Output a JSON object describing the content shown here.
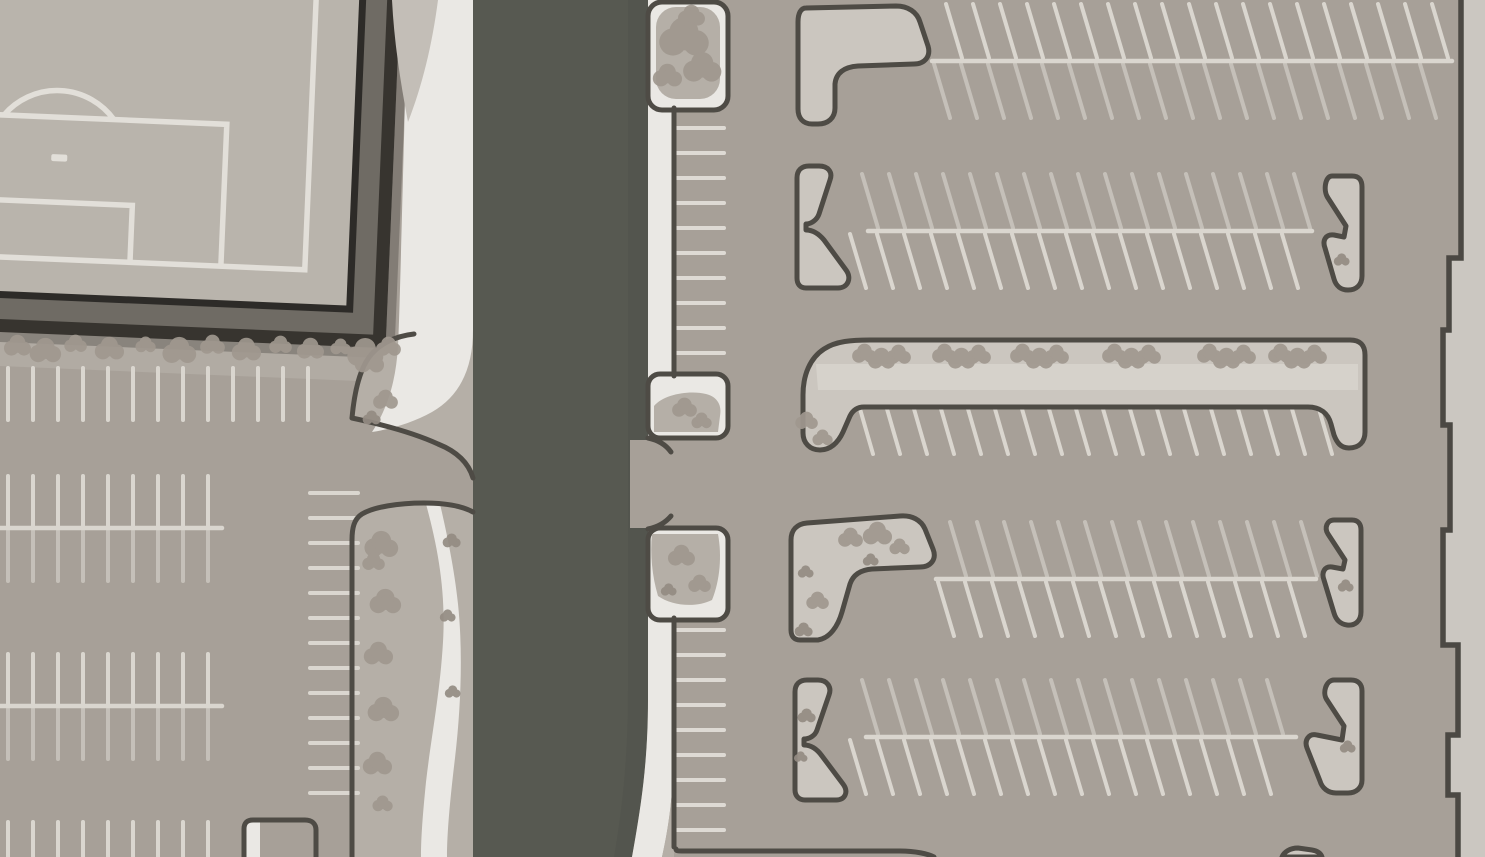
{
  "scene": {
    "type": "site-plan-map",
    "view": "top-down",
    "elements": [
      "sports-field",
      "road",
      "west-parking-lot",
      "east-parking-lot",
      "landscaped-medians",
      "parking-islands",
      "building-east-edge"
    ]
  },
  "palette": {
    "asphalt": "#a7a098",
    "road": "#575951",
    "road_shade": "#4f514b",
    "sidewalk": "#eae8e4",
    "median": "#b5afa7",
    "verge": "#c3beb7",
    "island": "#cbc6bf",
    "island_path": "#d6d2cb",
    "curb": "#4e4b45",
    "line_bright": "#dad6cf",
    "line_dim": "#c5c0b9",
    "line_white": "#dedad4",
    "tree": "#a0988f",
    "tree_small": "#948c83",
    "fence_outer": "#37342f",
    "fence_mid": "#6f6b64",
    "fence_inner": "#2d2b28",
    "field": "#b9b4ac",
    "field_line": "#e2dfd9",
    "planting": "#b1aba3",
    "building": "#cbc7c1",
    "wall": "#4b4843",
    "shadow": "rgba(35,33,30,0.28)"
  },
  "parking": {
    "stall_groups": [
      {
        "id": "left-top-row",
        "orient": "v",
        "x": 8,
        "y": 368,
        "count": 13,
        "spacing": 25,
        "length": 52,
        "tone": "bright"
      },
      {
        "id": "left-rowA-upper",
        "orient": "v",
        "x": 8,
        "y": 476,
        "count": 9,
        "spacing": 25,
        "length": 50,
        "tone": "bright"
      },
      {
        "id": "left-rowA-lower",
        "orient": "v",
        "x": 8,
        "y": 531,
        "count": 9,
        "spacing": 25,
        "length": 50,
        "tone": "dim"
      },
      {
        "id": "left-rowB-upper",
        "orient": "v",
        "x": 8,
        "y": 654,
        "count": 9,
        "spacing": 25,
        "length": 50,
        "tone": "bright"
      },
      {
        "id": "left-rowB-lower",
        "orient": "v",
        "x": 8,
        "y": 709,
        "count": 9,
        "spacing": 25,
        "length": 50,
        "tone": "dim"
      },
      {
        "id": "left-bottom-row",
        "orient": "v",
        "x": 8,
        "y": 822,
        "count": 9,
        "spacing": 25,
        "length": 35,
        "tone": "bright"
      },
      {
        "id": "left-median-stalls",
        "orient": "h",
        "x": 310,
        "y": 493,
        "count": 13,
        "spacing": 25,
        "length": 48,
        "tone": "bright"
      },
      {
        "id": "road-east-stalls-upper",
        "orient": "h",
        "x": 676,
        "y": 128,
        "count": 10,
        "spacing": 25,
        "length": 48,
        "tone": "white"
      },
      {
        "id": "road-east-stalls-lower",
        "orient": "h",
        "x": 676,
        "y": 630,
        "count": 9,
        "spacing": 25,
        "length": 48,
        "tone": "white"
      },
      {
        "id": "row1-upper",
        "orient": "d",
        "x": 946,
        "y": 4,
        "count": 19,
        "spacing": 27,
        "length": 54,
        "dx": 16,
        "tone": "bright"
      },
      {
        "id": "row1-lower",
        "orient": "d",
        "x": 934,
        "y": 64,
        "count": 19,
        "spacing": 27,
        "length": 54,
        "dx": 16,
        "tone": "dim"
      },
      {
        "id": "row2-upper",
        "orient": "d",
        "x": 862,
        "y": 174,
        "count": 17,
        "spacing": 27,
        "length": 54,
        "dx": 16,
        "tone": "dim"
      },
      {
        "id": "row2-lower",
        "orient": "d",
        "x": 850,
        "y": 234,
        "count": 17,
        "spacing": 27,
        "length": 54,
        "dx": 16,
        "tone": "bright"
      },
      {
        "id": "row3-stalls",
        "orient": "d",
        "x": 858,
        "y": 402,
        "count": 18,
        "spacing": 27,
        "length": 52,
        "dx": 15,
        "tone": "bright"
      },
      {
        "id": "row4-upper",
        "orient": "d",
        "x": 950,
        "y": 522,
        "count": 14,
        "spacing": 27,
        "length": 54,
        "dx": 16,
        "tone": "dim"
      },
      {
        "id": "row4-lower",
        "orient": "d",
        "x": 938,
        "y": 582,
        "count": 14,
        "spacing": 27,
        "length": 54,
        "dx": 16,
        "tone": "bright"
      },
      {
        "id": "row5-upper",
        "orient": "d",
        "x": 862,
        "y": 680,
        "count": 16,
        "spacing": 27,
        "length": 54,
        "dx": 16,
        "tone": "dim"
      },
      {
        "id": "row5-lower",
        "orient": "d",
        "x": 850,
        "y": 740,
        "count": 16,
        "spacing": 27,
        "length": 54,
        "dx": 16,
        "tone": "bright"
      }
    ],
    "aisle_center_lines": [
      {
        "x1": 0,
        "y1": 528,
        "x2": 222,
        "y2": 528
      },
      {
        "x1": 0,
        "y1": 706,
        "x2": 222,
        "y2": 706
      },
      {
        "x1": 932,
        "y1": 61,
        "x2": 1452,
        "y2": 61
      },
      {
        "x1": 868,
        "y1": 231,
        "x2": 1312,
        "y2": 231
      },
      {
        "x1": 936,
        "y1": 579,
        "x2": 1316,
        "y2": 579
      },
      {
        "x1": 866,
        "y1": 737,
        "x2": 1296,
        "y2": 737
      }
    ]
  },
  "landscape": {
    "trees": [
      [
        18,
        346,
        12
      ],
      [
        46,
        351,
        14
      ],
      [
        76,
        344,
        10
      ],
      [
        110,
        349,
        13
      ],
      [
        146,
        345,
        9
      ],
      [
        180,
        351,
        15
      ],
      [
        213,
        345,
        11
      ],
      [
        247,
        350,
        13
      ],
      [
        281,
        345,
        10
      ],
      [
        311,
        349,
        12
      ],
      [
        341,
        347,
        9
      ],
      [
        366,
        353,
        16
      ],
      [
        389,
        347,
        11
      ],
      [
        370,
        362,
        13
      ],
      [
        386,
        400,
        11
      ],
      [
        372,
        418,
        8
      ],
      [
        382,
        545,
        15
      ],
      [
        374,
        562,
        10
      ],
      [
        386,
        602,
        14
      ],
      [
        379,
        654,
        13
      ],
      [
        384,
        710,
        14
      ],
      [
        378,
        764,
        13
      ],
      [
        383,
        804,
        9
      ],
      [
        452,
        541,
        8
      ],
      [
        448,
        616,
        7
      ],
      [
        453,
        692,
        7
      ],
      [
        685,
        38,
        22
      ],
      [
        703,
        68,
        17
      ],
      [
        668,
        76,
        13
      ],
      [
        692,
        16,
        12
      ],
      [
        685,
        408,
        11
      ],
      [
        702,
        421,
        9
      ],
      [
        682,
        556,
        12
      ],
      [
        700,
        584,
        10
      ],
      [
        669,
        590,
        7
      ],
      [
        807,
        421,
        10
      ],
      [
        823,
        438,
        9
      ],
      [
        851,
        538,
        11
      ],
      [
        878,
        534,
        13
      ],
      [
        900,
        547,
        9
      ],
      [
        871,
        560,
        7
      ],
      [
        806,
        572,
        7
      ],
      [
        818,
        601,
        10
      ],
      [
        804,
        630,
        8
      ],
      [
        1346,
        586,
        7
      ],
      [
        807,
        716,
        8
      ],
      [
        801,
        757,
        6
      ],
      [
        1348,
        747,
        7
      ],
      [
        1342,
        260,
        7
      ]
    ],
    "tree_clusters": {
      "y": 356,
      "xs": [
        882,
        962,
        1040,
        1132,
        1227,
        1298
      ],
      "puff_r": 12
    }
  }
}
